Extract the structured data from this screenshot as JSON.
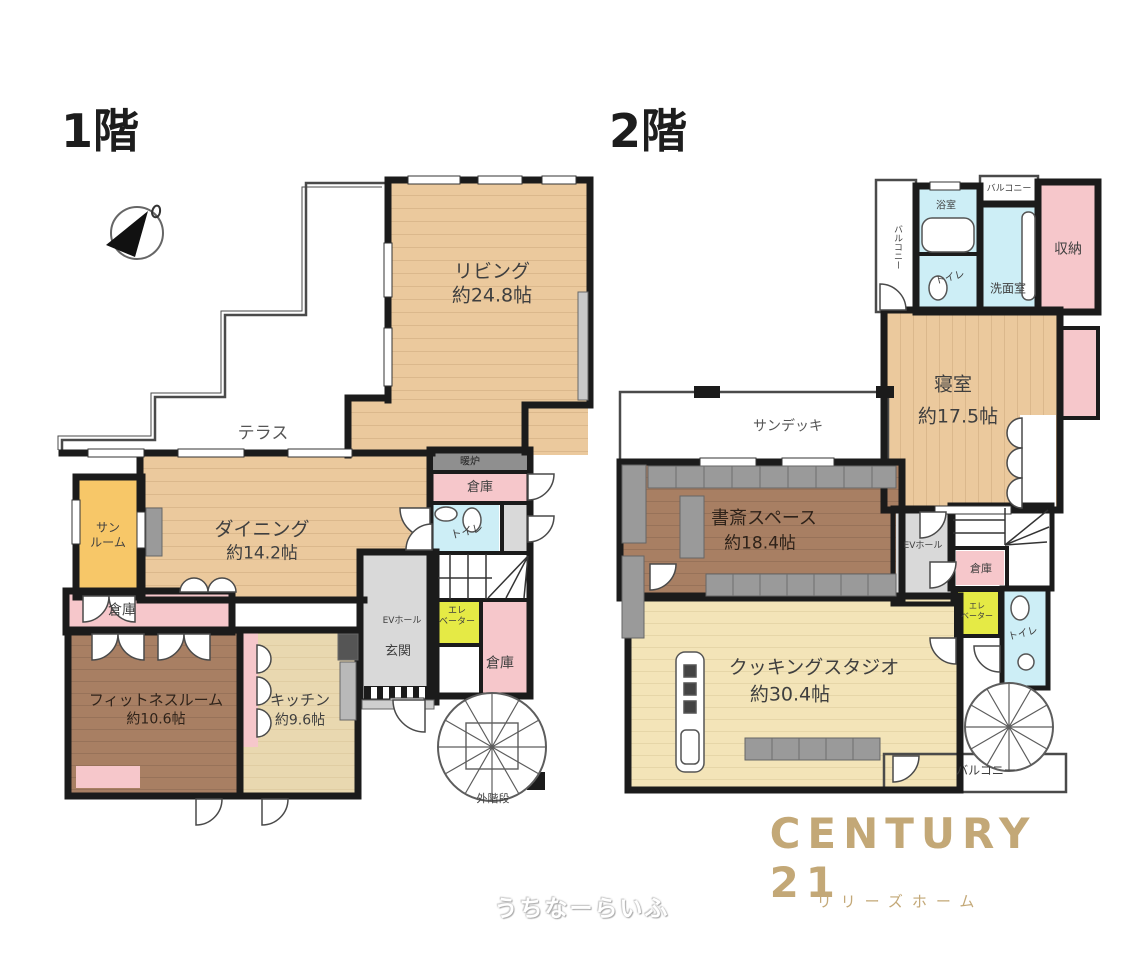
{
  "floor1": {
    "title": "1階",
    "living": {
      "name": "リビング",
      "size": "約24.8帖"
    },
    "terrace": "テラス",
    "dining": {
      "name": "ダイニング",
      "size": "約14.2帖"
    },
    "sunroom": {
      "l1": "サン",
      "l2": "ルーム"
    },
    "storage_west": "倉庫",
    "fitness": {
      "name": "フィットネスルーム",
      "size": "約10.6帖"
    },
    "kitchen": {
      "name": "キッチン",
      "size": "約9.6帖"
    },
    "fireplace": "暖炉",
    "storage_north": "倉庫",
    "toilet": "トイレ",
    "ev_hall": "EVホール",
    "elevator": {
      "l1": "エレ",
      "l2": "ベーター"
    },
    "entrance": "玄関",
    "storage_south": "倉庫",
    "outdoor_stairs": "外階段"
  },
  "floor2": {
    "title": "2階",
    "balcony_west": "バルコニー",
    "bathroom": "浴室",
    "balcony_north": "バルコニー",
    "washroom": "洗面室",
    "toilet_north": "トイレ",
    "closet": "収納",
    "bedroom": {
      "name": "寝室",
      "size": "約17.5帖"
    },
    "sundeck": "サンデッキ",
    "study": {
      "name": "書斎スペース",
      "size": "約18.4帖"
    },
    "ev_hall": "EVホール",
    "storage": "倉庫",
    "elevator": {
      "l1": "エレ",
      "l2": "ベーター"
    },
    "toilet_east": "トイレ",
    "cooking_studio": {
      "name": "クッキングスタジオ",
      "size": "約30.4帖"
    },
    "balcony_south": "バルコニー"
  },
  "branding": {
    "logo": "CENTURY 21",
    "company": "リリーズホーム",
    "watermark": "うちなーらいふ"
  },
  "colors": {
    "wood": "#ebc99d",
    "cream": "#f3e4b8",
    "brown": "#a87f63",
    "pink": "#f6c7cb",
    "blue": "#cdeef6",
    "yellow": "#e5ea45",
    "orange": "#f7c768",
    "gray": "#d9d9d9",
    "wall": "#1b1b1b",
    "gold": "#c3a877"
  }
}
